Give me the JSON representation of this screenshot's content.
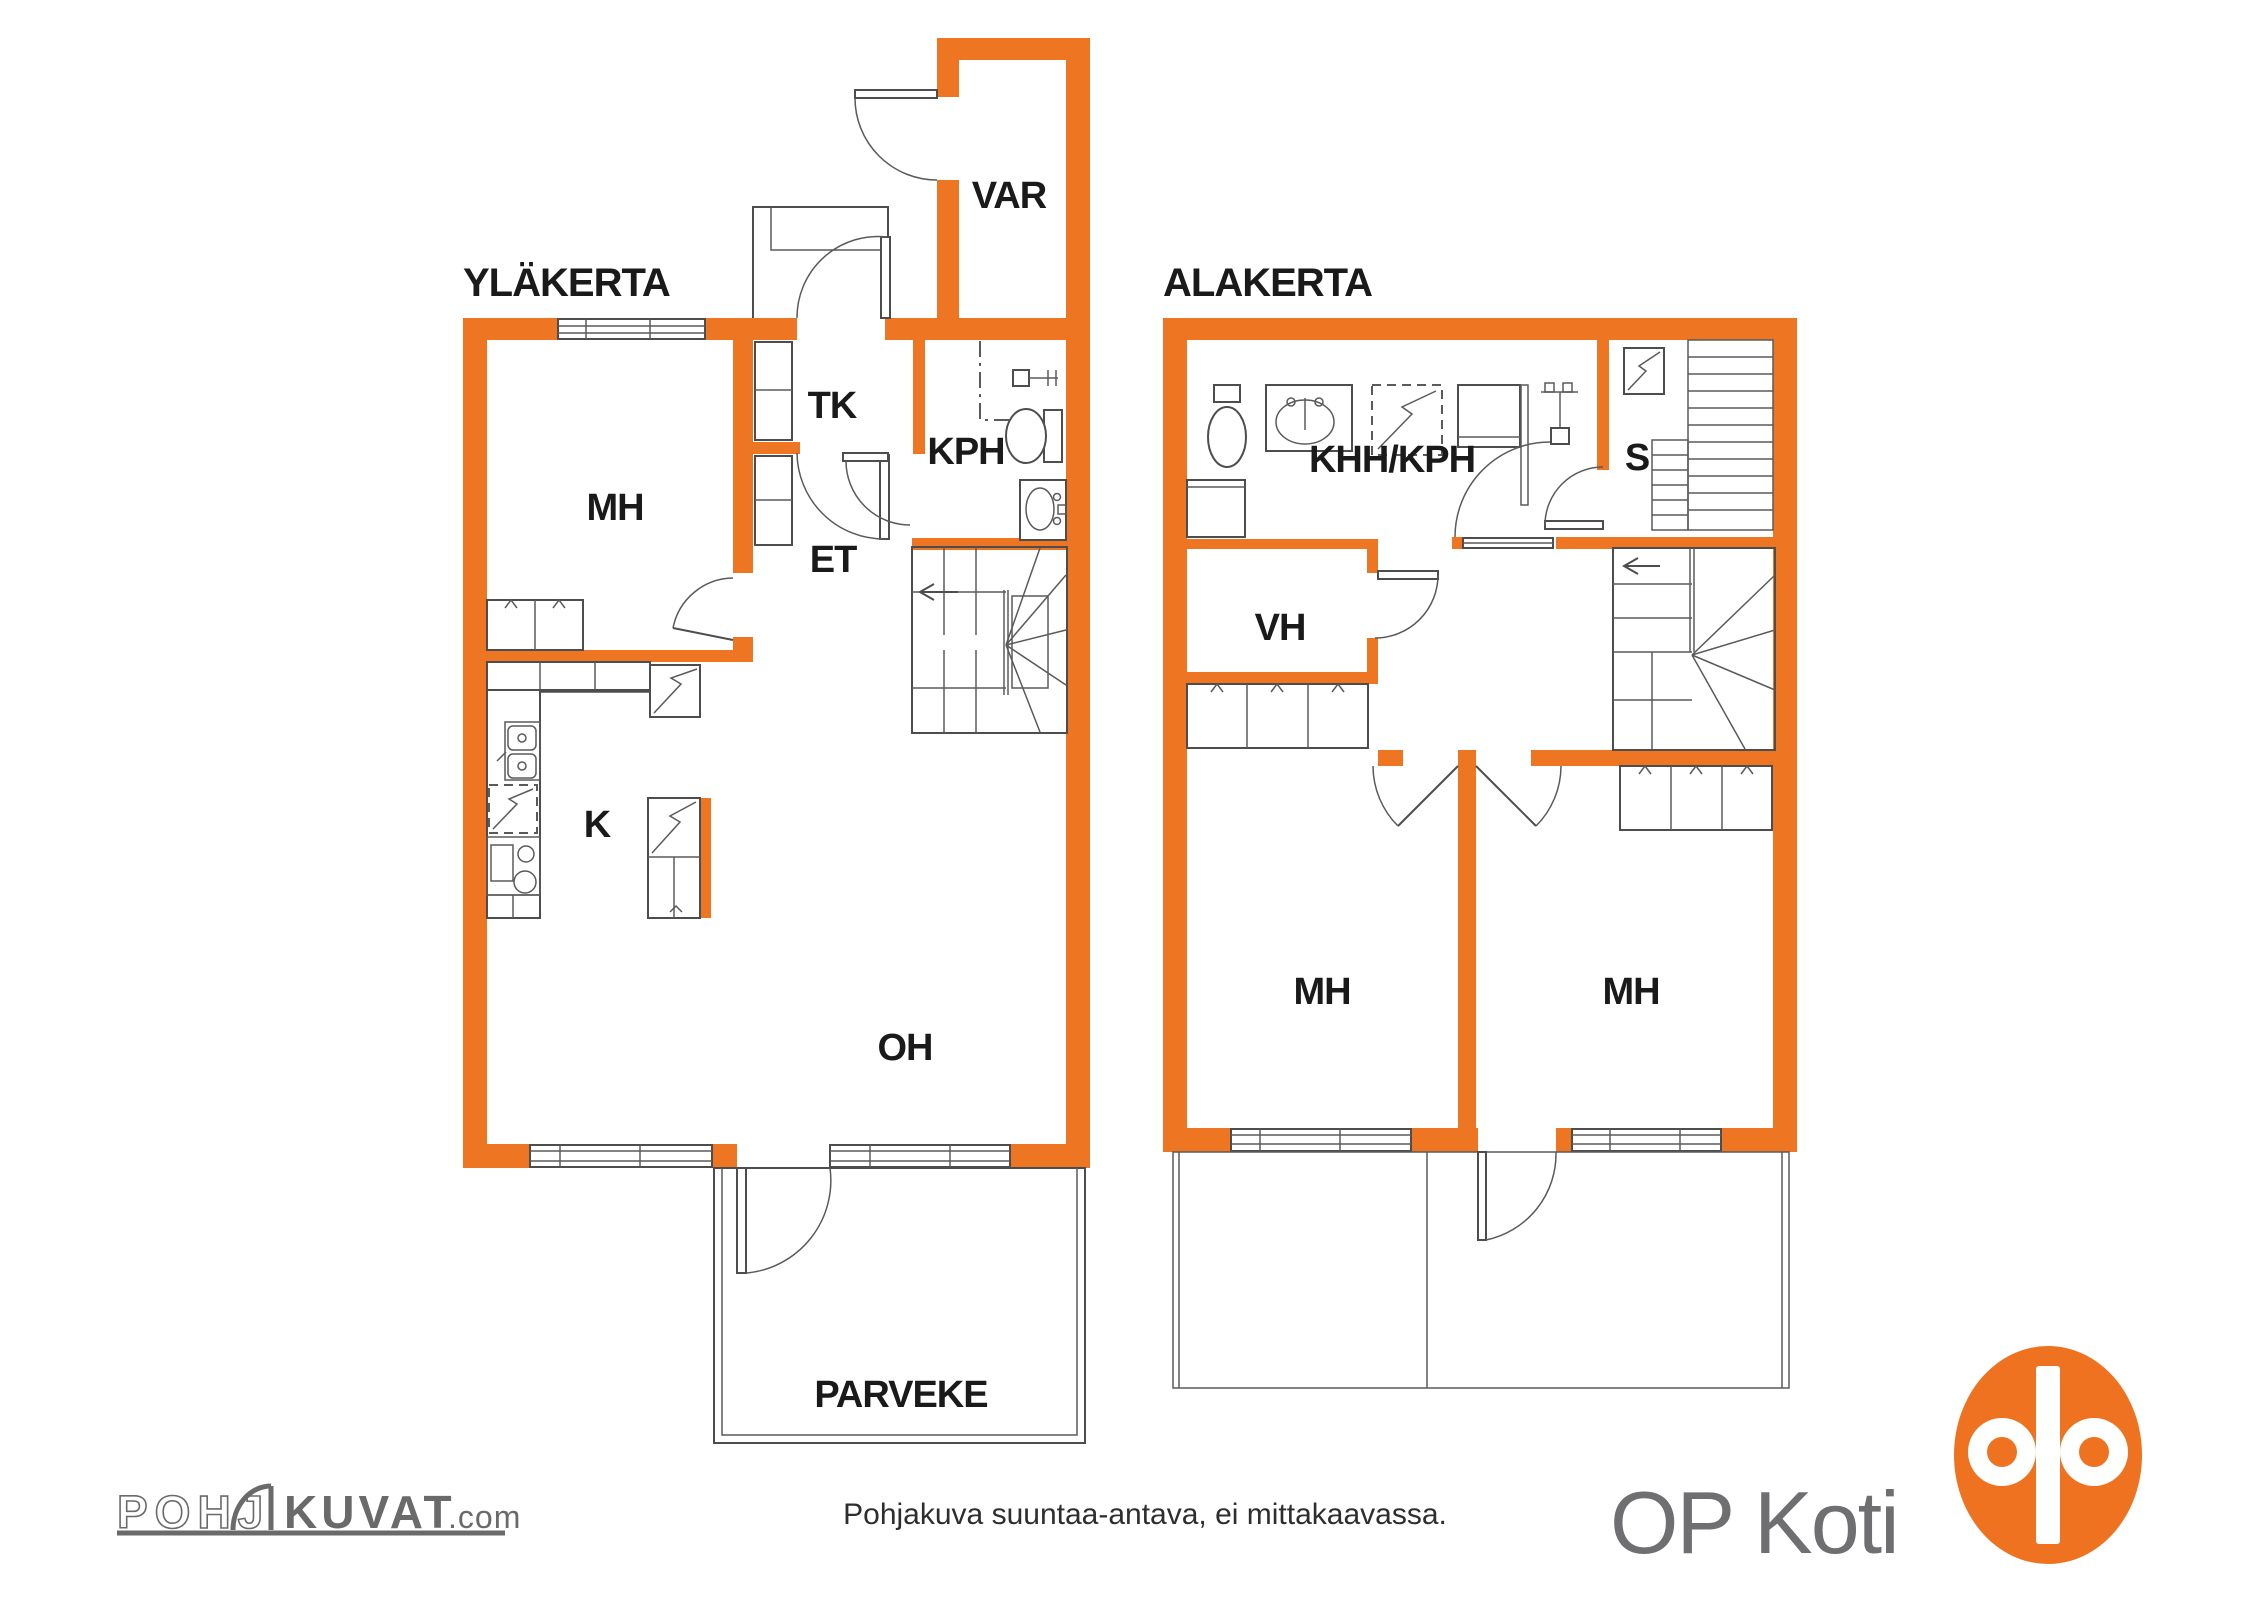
{
  "colors": {
    "wall_orange": "#EE7623",
    "logo_orange": "#EE7220",
    "line_gray": "#4d4d4d",
    "label_black": "#1a1a1a",
    "brand_gray": "#6f6f72",
    "footer_logo_gray": "#6a6a6a"
  },
  "floors": {
    "ylakerta": {
      "title": "YLÄKERTA",
      "rooms": [
        {
          "id": "var",
          "label": "VAR"
        },
        {
          "id": "tk",
          "label": "TK"
        },
        {
          "id": "kph",
          "label": "KPH"
        },
        {
          "id": "mh",
          "label": "MH"
        },
        {
          "id": "et",
          "label": "ET"
        },
        {
          "id": "k",
          "label": "K"
        },
        {
          "id": "oh",
          "label": "OH"
        },
        {
          "id": "parveke",
          "label": "PARVEKE"
        }
      ]
    },
    "alakerta": {
      "title": "ALAKERTA",
      "rooms": [
        {
          "id": "khh_kph",
          "label": "KHH/KPH"
        },
        {
          "id": "s",
          "label": "S"
        },
        {
          "id": "vh",
          "label": "VH"
        },
        {
          "id": "mh1",
          "label": "MH"
        },
        {
          "id": "mh2",
          "label": "MH"
        }
      ]
    }
  },
  "footer": {
    "disclaimer": "Pohjakuva suuntaa-antava, ei mittakaavassa.",
    "brand": "OP Koti",
    "pohjakuvat": {
      "part1": "POHJ",
      "part2": "KUVAT",
      "suffix": ".com"
    }
  }
}
